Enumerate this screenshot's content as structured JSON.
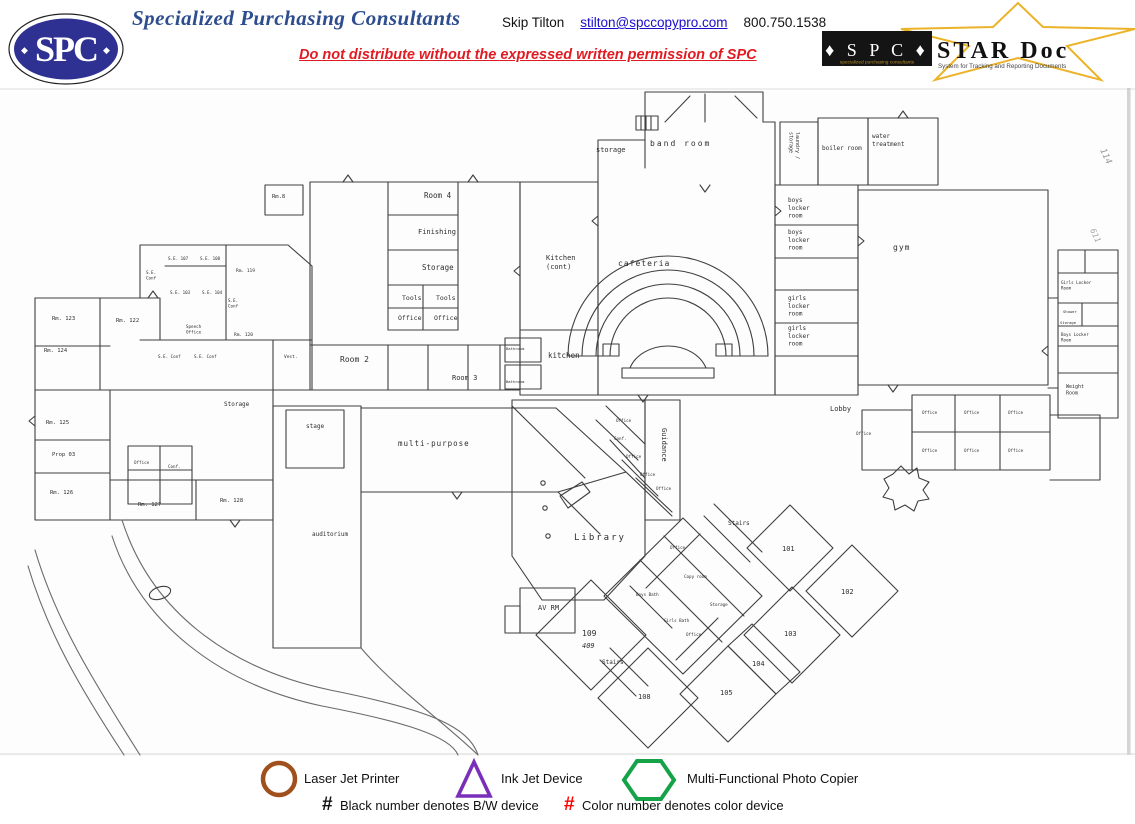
{
  "header": {
    "logo_text": "SPC",
    "logo_marks": "♦ SPC ♦",
    "company": "Specialized Purchasing Consultants",
    "contact_name": "Skip Tilton",
    "contact_email": "stilton@spccopypro.com",
    "contact_phone": "800.750.1538",
    "warning": "Do not distribute without the expressed written permission of SPC",
    "stardoc": {
      "spc_text": "♦ S P C ♦",
      "spc_sub": "specialized purchasing consultants",
      "title": "STAR Doc",
      "tagline": "System for Tracking and Reporting Documents",
      "star_color": "#ecb32a"
    },
    "colors": {
      "title_blue": "#2d4d8e",
      "logo_navy": "#2e3192",
      "warning_red": "#e11b22"
    }
  },
  "plan": {
    "rooms": [
      {
        "label": "storage",
        "x": 596,
        "y": 64,
        "s": 7
      },
      {
        "label": "band room",
        "x": 650,
        "y": 58,
        "s": 8,
        "ls": 2
      },
      {
        "label": "laundry /\nstorage",
        "x": 796,
        "y": 44,
        "s": 5,
        "rot": 90
      },
      {
        "label": "boiler room",
        "x": 822,
        "y": 62,
        "s": 6
      },
      {
        "label": "water\ntreatment",
        "x": 872,
        "y": 50,
        "s": 6
      },
      {
        "label": "boys\nlocker\nroom",
        "x": 788,
        "y": 114,
        "s": 6
      },
      {
        "label": "boys\nlocker\nroom",
        "x": 788,
        "y": 146,
        "s": 6
      },
      {
        "label": "girls\nlocker\nroom",
        "x": 788,
        "y": 212,
        "s": 6
      },
      {
        "label": "girls\nlocker\nroom",
        "x": 788,
        "y": 242,
        "s": 6
      },
      {
        "label": "gym",
        "x": 893,
        "y": 162,
        "s": 8,
        "ls": 1
      },
      {
        "label": "cafeteria",
        "x": 618,
        "y": 178,
        "s": 8,
        "ls": 1
      },
      {
        "label": "Kitchen\n(cont)",
        "x": 546,
        "y": 172,
        "s": 7
      },
      {
        "label": "kitchen",
        "x": 548,
        "y": 270,
        "s": 7.5
      },
      {
        "label": "Room 4",
        "x": 424,
        "y": 110,
        "s": 7.5
      },
      {
        "label": "Finishing",
        "x": 418,
        "y": 146,
        "s": 7
      },
      {
        "label": "Storage",
        "x": 422,
        "y": 182,
        "s": 7.5
      },
      {
        "label": "Tools",
        "x": 402,
        "y": 212,
        "s": 6.5
      },
      {
        "label": "Tools",
        "x": 436,
        "y": 212,
        "s": 6.5
      },
      {
        "label": "Office",
        "x": 398,
        "y": 232,
        "s": 6.5
      },
      {
        "label": "Office",
        "x": 434,
        "y": 232,
        "s": 6.5
      },
      {
        "label": "Room 2",
        "x": 340,
        "y": 274,
        "s": 8
      },
      {
        "label": "Room 3",
        "x": 452,
        "y": 292,
        "s": 7
      },
      {
        "label": "Rm.8",
        "x": 272,
        "y": 110,
        "s": 5.5
      },
      {
        "label": "Rm. 123",
        "x": 52,
        "y": 232,
        "s": 5.5
      },
      {
        "label": "Rm. 122",
        "x": 116,
        "y": 234,
        "s": 5.5
      },
      {
        "label": "Rm. 124",
        "x": 44,
        "y": 264,
        "s": 5.5
      },
      {
        "label": "Rm. 125",
        "x": 46,
        "y": 336,
        "s": 5.5
      },
      {
        "label": "Prop 03",
        "x": 52,
        "y": 368,
        "s": 5.5
      },
      {
        "label": "Rm. 126",
        "x": 50,
        "y": 406,
        "s": 5.5
      },
      {
        "label": "Rm. 127",
        "x": 138,
        "y": 418,
        "s": 5.5
      },
      {
        "label": "Rm. 128",
        "x": 220,
        "y": 414,
        "s": 5.5
      },
      {
        "label": "S.E. 107",
        "x": 168,
        "y": 172,
        "s": 4.2
      },
      {
        "label": "S.E. 108",
        "x": 200,
        "y": 172,
        "s": 4.2
      },
      {
        "label": "S.E.\nConf",
        "x": 146,
        "y": 186,
        "s": 4.2
      },
      {
        "label": "S.E. 103",
        "x": 170,
        "y": 206,
        "s": 4.2
      },
      {
        "label": "S.E. 104",
        "x": 202,
        "y": 206,
        "s": 4.2
      },
      {
        "label": "S.E.\nConf",
        "x": 228,
        "y": 214,
        "s": 4.2
      },
      {
        "label": "Speech\nOffice",
        "x": 186,
        "y": 240,
        "s": 4.2
      },
      {
        "label": "S.E. Conf",
        "x": 158,
        "y": 270,
        "s": 4.2
      },
      {
        "label": "S.E. Conf",
        "x": 194,
        "y": 270,
        "s": 4.2
      },
      {
        "label": "Rm. 119",
        "x": 236,
        "y": 184,
        "s": 4.5
      },
      {
        "label": "Rm. 120",
        "x": 234,
        "y": 248,
        "s": 4.5
      },
      {
        "label": "Storage",
        "x": 224,
        "y": 318,
        "s": 6
      },
      {
        "label": "Office",
        "x": 134,
        "y": 376,
        "s": 4.2
      },
      {
        "label": "Conf.",
        "x": 168,
        "y": 380,
        "s": 4.2
      },
      {
        "label": "Vest.",
        "x": 284,
        "y": 270,
        "s": 4.5
      },
      {
        "label": "stage",
        "x": 306,
        "y": 340,
        "s": 6
      },
      {
        "label": "multi-purpose",
        "x": 398,
        "y": 358,
        "s": 7.5,
        "ls": 1
      },
      {
        "label": "auditorium",
        "x": 312,
        "y": 448,
        "s": 6
      },
      {
        "label": "Guidance",
        "x": 662,
        "y": 340,
        "s": 7,
        "rot": 90
      },
      {
        "label": "Office",
        "x": 616,
        "y": 334,
        "s": 4.2
      },
      {
        "label": "Conf.",
        "x": 614,
        "y": 352,
        "s": 4.2
      },
      {
        "label": "Office",
        "x": 626,
        "y": 370,
        "s": 4.2
      },
      {
        "label": "Office",
        "x": 640,
        "y": 388,
        "s": 4.2
      },
      {
        "label": "Office",
        "x": 656,
        "y": 402,
        "s": 4.2
      },
      {
        "label": "Library",
        "x": 574,
        "y": 452,
        "s": 9,
        "ls": 2
      },
      {
        "label": "AV RM",
        "x": 538,
        "y": 522,
        "s": 7
      },
      {
        "label": "109",
        "x": 582,
        "y": 548,
        "s": 8
      },
      {
        "label": "409",
        "x": 582,
        "y": 560,
        "s": 7,
        "i": true
      },
      {
        "label": "Stairs",
        "x": 602,
        "y": 576,
        "s": 6
      },
      {
        "label": "108",
        "x": 638,
        "y": 611,
        "s": 7
      },
      {
        "label": "105",
        "x": 720,
        "y": 607,
        "s": 7
      },
      {
        "label": "104",
        "x": 752,
        "y": 578,
        "s": 7
      },
      {
        "label": "103",
        "x": 784,
        "y": 548,
        "s": 7
      },
      {
        "label": "102",
        "x": 841,
        "y": 506,
        "s": 7
      },
      {
        "label": "101",
        "x": 782,
        "y": 463,
        "s": 7
      },
      {
        "label": "Stairs",
        "x": 728,
        "y": 437,
        "s": 6
      },
      {
        "label": "Office",
        "x": 670,
        "y": 461,
        "s": 4.2
      },
      {
        "label": "Copy room",
        "x": 684,
        "y": 490,
        "s": 4.2
      },
      {
        "label": "Boys Bath",
        "x": 636,
        "y": 508,
        "s": 4.2
      },
      {
        "label": "Storage",
        "x": 710,
        "y": 518,
        "s": 4.2
      },
      {
        "label": "Girls Bath",
        "x": 664,
        "y": 534,
        "s": 4.2
      },
      {
        "label": "Office",
        "x": 686,
        "y": 548,
        "s": 4.2
      },
      {
        "label": "Lobby",
        "x": 830,
        "y": 323,
        "s": 7
      },
      {
        "label": "Weight\nRoom",
        "x": 1066,
        "y": 300,
        "s": 5
      },
      {
        "label": "Girls Locker\nRoom",
        "x": 1061,
        "y": 196,
        "s": 4.2
      },
      {
        "label": "Shower",
        "x": 1063,
        "y": 225,
        "s": 3.8
      },
      {
        "label": "Storage",
        "x": 1060,
        "y": 236,
        "s": 3.8
      },
      {
        "label": "Boys Locker\nRoom",
        "x": 1061,
        "y": 248,
        "s": 4.2
      },
      {
        "label": "Office",
        "x": 856,
        "y": 347,
        "s": 4.2
      },
      {
        "label": "Office",
        "x": 922,
        "y": 326,
        "s": 4.2
      },
      {
        "label": "Office",
        "x": 964,
        "y": 326,
        "s": 4.2
      },
      {
        "label": "Office",
        "x": 1008,
        "y": 326,
        "s": 4.2
      },
      {
        "label": "Office",
        "x": 922,
        "y": 364,
        "s": 4.2
      },
      {
        "label": "Office",
        "x": 964,
        "y": 364,
        "s": 4.2
      },
      {
        "label": "Office",
        "x": 1008,
        "y": 364,
        "s": 4.2
      },
      {
        "label": "Bathroom",
        "x": 506,
        "y": 262,
        "s": 3.8
      },
      {
        "label": "Bathroom",
        "x": 506,
        "y": 295,
        "s": 3.8
      },
      {
        "label": "114",
        "x": 1100,
        "y": 62,
        "s": 9,
        "rot": 65,
        "c": "#9b9b9b",
        "i": true
      },
      {
        "label": "611",
        "x": 1090,
        "y": 142,
        "s": 8,
        "rot": 65,
        "c": "#a8a8a8",
        "i": true
      }
    ]
  },
  "legend": {
    "items": [
      {
        "shape": "circle",
        "color": "#a0501c",
        "label": "Laser Jet Printer"
      },
      {
        "shape": "triangle",
        "color": "#7a2fbb",
        "label": "Ink Jet Device"
      },
      {
        "shape": "hexagon",
        "color": "#16a348",
        "label": "Multi-Functional Photo Copier"
      }
    ],
    "notes": [
      {
        "symbol": "#",
        "color": "#111111",
        "label": "Black number denotes B/W device"
      },
      {
        "symbol": "#",
        "color": "#ff0000",
        "label": "Color number denotes color device"
      }
    ]
  }
}
